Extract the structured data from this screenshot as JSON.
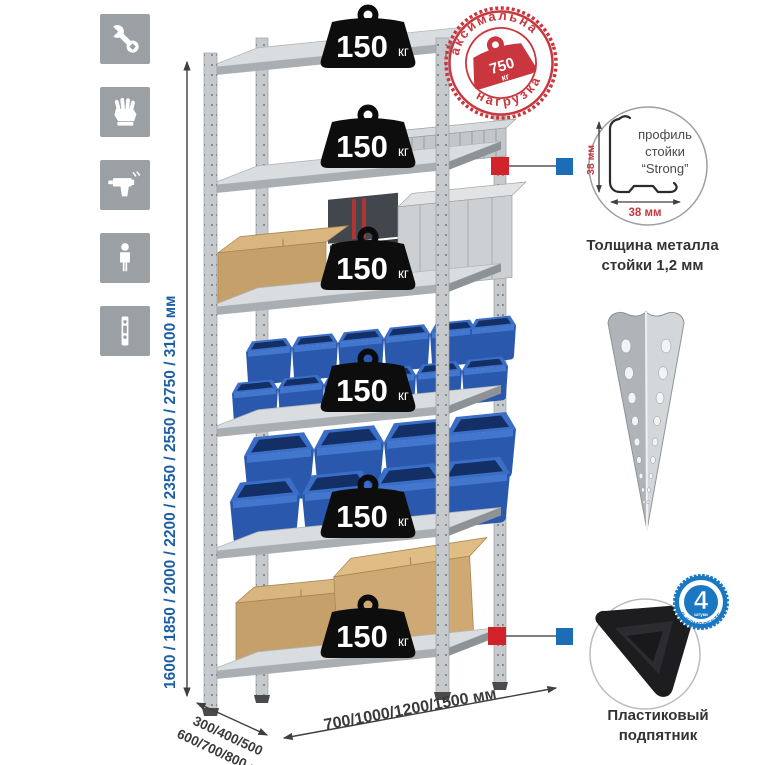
{
  "dimensions": {
    "height": "1600 / 1850 / 2000 / 2200 / 2350 / 2550 / 2750 / 3100 мм",
    "depth_line1": "300/400/500",
    "depth_line2": "600/700/800 мм",
    "width": "700/1000/1200/1500 мм"
  },
  "shelf_loads": [
    {
      "value": "150",
      "unit": "кг"
    },
    {
      "value": "150",
      "unit": "кг"
    },
    {
      "value": "150",
      "unit": "кг"
    },
    {
      "value": "150",
      "unit": "кг"
    },
    {
      "value": "150",
      "unit": "кг"
    },
    {
      "value": "150",
      "unit": "кг"
    }
  ],
  "stamp": {
    "arc_top": "максимальная",
    "arc_bottom": "нагрузка",
    "value": "750",
    "unit": "кг"
  },
  "profile_detail": {
    "line1": "профиль",
    "line2": "стойки",
    "line3": "“Strong”",
    "dim_v": "38 мм",
    "dim_h": "38 мм"
  },
  "thickness_caption": {
    "line1": "Толщина металла",
    "line2": "стойки 1,2 мм"
  },
  "foot_caption": {
    "line1": "Пластиковый",
    "line2": "подпятник"
  },
  "kit_badge": {
    "value": "4",
    "small": "штуки",
    "arc": "в комплекте"
  },
  "sidebar": {
    "icons": [
      {
        "name": "wrench"
      },
      {
        "name": "gloves"
      },
      {
        "name": "drill"
      },
      {
        "name": "person"
      },
      {
        "name": "perforated-post"
      }
    ]
  },
  "colors": {
    "stamp_red": "#c9363e",
    "marker_red": "#d2232a",
    "marker_blue": "#1b6eb5",
    "dimension_blue": "#1d5fa6",
    "bin_blue": "#2a58ad",
    "kit_badge_blue": "#1a78c2",
    "metal_gray": "#c6cacd",
    "tile_gray": "#9aa0a4",
    "cardboard": "#c5a06b",
    "weight_black": "#0d0d0d"
  }
}
